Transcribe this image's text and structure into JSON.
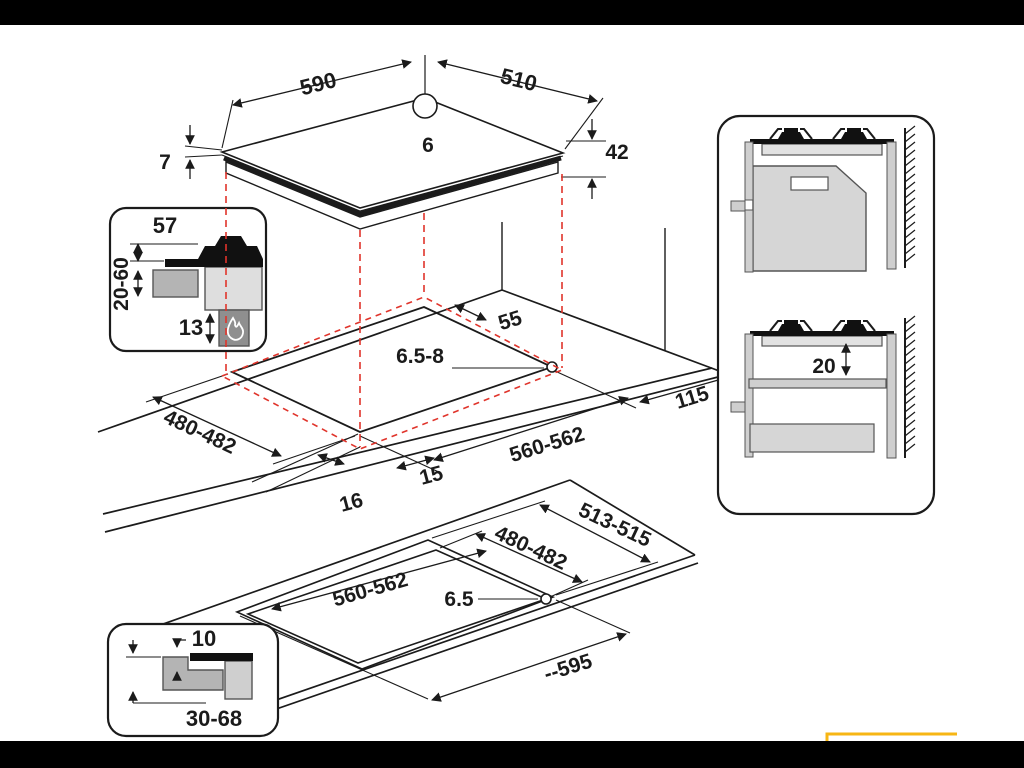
{
  "hob_top_view": {
    "width": "590",
    "depth": "510",
    "burner_hole": "6",
    "body_height": "42",
    "glass_thickness": "7"
  },
  "burner_section_inset": {
    "height_above_worktop": "57",
    "worktop_thickness": "20-60",
    "bottom_clearance": "13"
  },
  "worktop_cutout_view": {
    "rear_clearance": "55",
    "corner_hole": "6.5-8",
    "cutout_depth": "480-482",
    "cutout_width": "560-562",
    "side_clearance": "115",
    "front_offset": "15",
    "front_edge": "16"
  },
  "wall_side_views": {
    "shelf_clearance": "20"
  },
  "flush_mount_view": {
    "recess_depth": "513-515",
    "cutout_depth": "480-482",
    "cutout_width": "560-562",
    "corner_hole": "6.5",
    "recess_width": "--595"
  },
  "flush_section_inset": {
    "rebate_depth": "10",
    "worktop_thickness": "30-68"
  },
  "colors": {
    "projection": "#e0342b",
    "highlight": "#f7b614",
    "ink": "#1b1b1b"
  }
}
